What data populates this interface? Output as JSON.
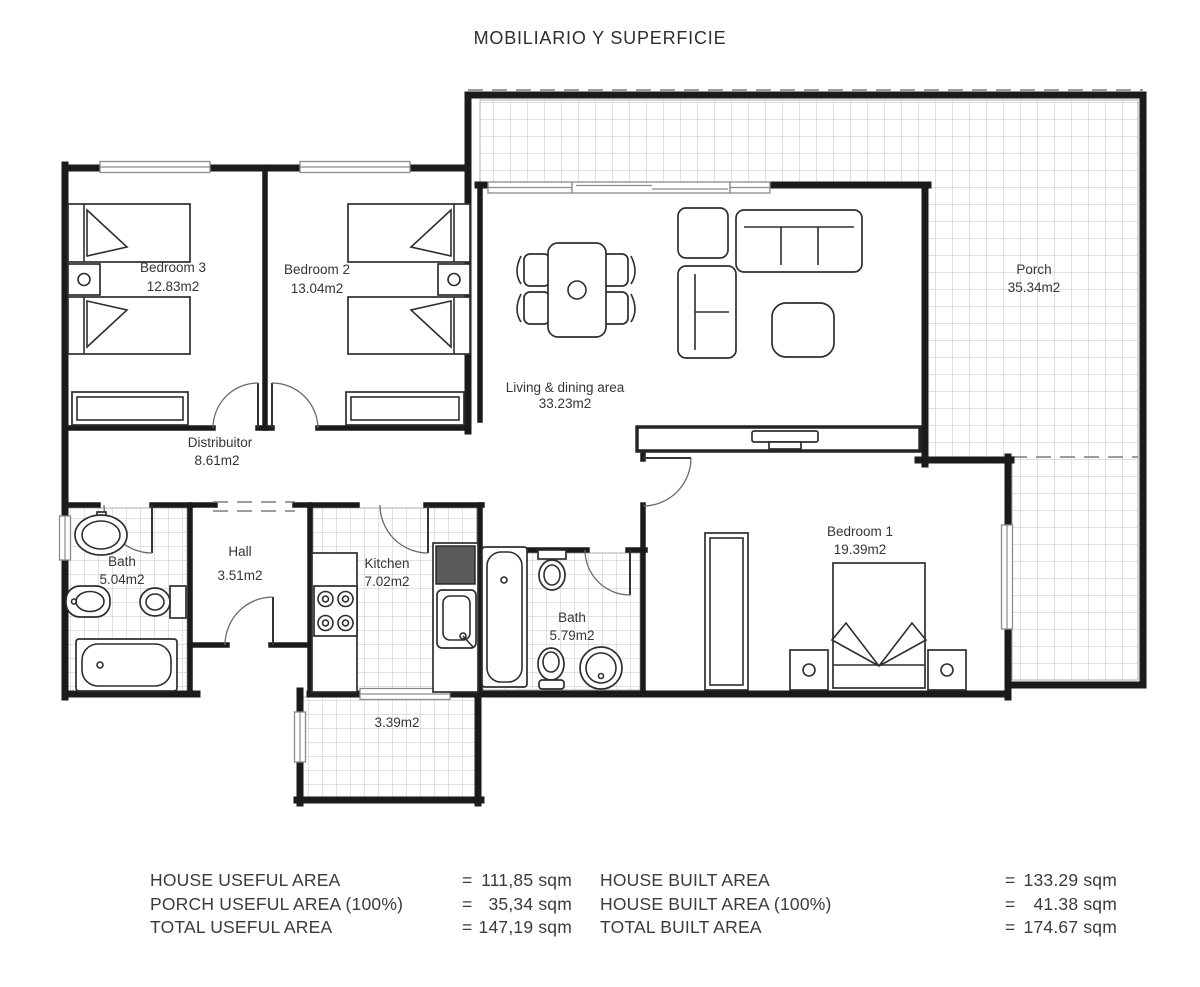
{
  "title": "MOBILIARIO Y SUPERFICIE",
  "rooms": {
    "bedroom3": {
      "name": "Bedroom 3",
      "area": "12.83m2"
    },
    "bedroom2": {
      "name": "Bedroom 2",
      "area": "13.04m2"
    },
    "living": {
      "name": "Living & dining area",
      "area": "33.23m2"
    },
    "porch": {
      "name": "Porch",
      "area": "35.34m2"
    },
    "distributor": {
      "name": "Distribuitor",
      "area": "8.61m2"
    },
    "bath1": {
      "name": "Bath",
      "area": "5.04m2"
    },
    "hall": {
      "name": "Hall",
      "area": "3.51m2"
    },
    "kitchen": {
      "name": "Kitchen",
      "area": "7.02m2"
    },
    "bath2": {
      "name": "Bath",
      "area": "5.79m2"
    },
    "bedroom1": {
      "name": "Bedroom 1",
      "area": "19.39m2"
    },
    "terrace": {
      "area": "3.39m2"
    }
  },
  "summary": {
    "left": [
      {
        "label": "HOUSE USEFUL AREA",
        "eq": "=",
        "value": "111,85 sqm"
      },
      {
        "label": "PORCH USEFUL AREA (100%)",
        "eq": "=",
        "value": "35,34 sqm"
      },
      {
        "label": "TOTAL USEFUL AREA",
        "eq": "=",
        "value": "147,19 sqm"
      }
    ],
    "right": [
      {
        "label": "HOUSE BUILT AREA",
        "eq": "=",
        "value": "133.29 sqm"
      },
      {
        "label": "HOUSE BUILT AREA (100%)",
        "eq": "=",
        "value": "41.38 sqm"
      },
      {
        "label": "TOTAL BUILT AREA",
        "eq": "=",
        "value": "174.67 sqm"
      }
    ]
  },
  "colors": {
    "wall": "#1b1b1b",
    "tile_line": "#c2c2c2",
    "text": "#3b3b3b",
    "paper": "#ffffff"
  }
}
